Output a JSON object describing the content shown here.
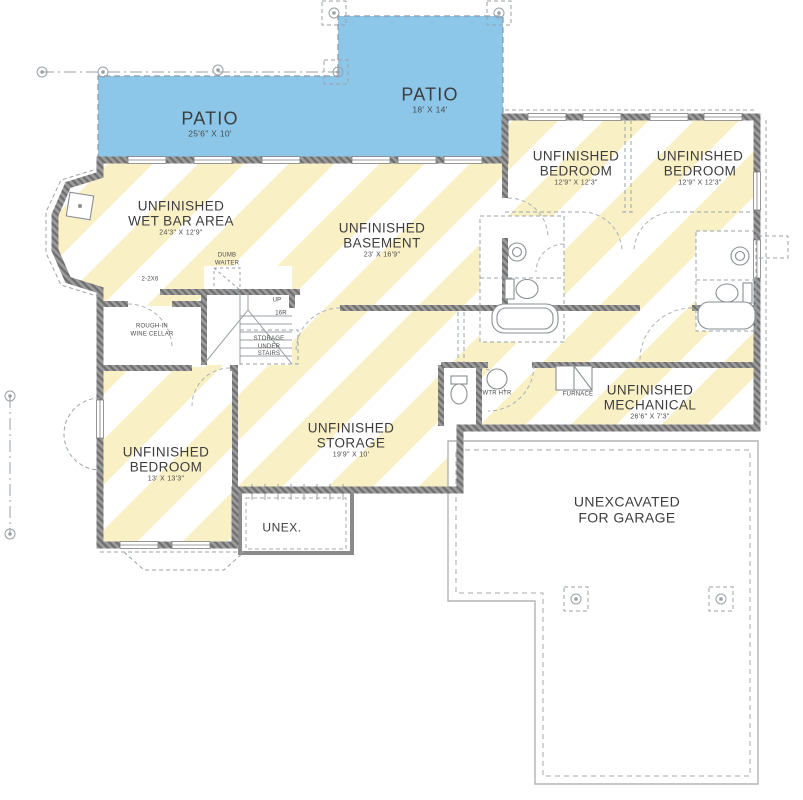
{
  "plan_type": "Basement Floor Plan",
  "colors": {
    "patio_fill": "#8CC7E9",
    "stripe_yellow": "#FAF0C6",
    "wall_base": "#9B9B9B",
    "wall_fleck": "#6E6E6E"
  },
  "rooms": {
    "patio_left": {
      "name": "PATIO",
      "dims": "25'6\" X 10'"
    },
    "patio_right": {
      "name": "PATIO",
      "dims": "18' X 14'"
    },
    "wet_bar": {
      "l1": "UNFINISHED",
      "l2": "WET BAR AREA",
      "dims": "24'3\" X 12'9\""
    },
    "basement": {
      "l1": "UNFINISHED",
      "l2": "BASEMENT",
      "dims": "23' X 16'9\""
    },
    "bedroom_top_left": {
      "l1": "UNFINISHED",
      "l2": "BEDROOM",
      "dims": "12'9\" X 12'3\""
    },
    "bedroom_top_right": {
      "l1": "UNFINISHED",
      "l2": "BEDROOM",
      "dims": "12'9\" X 12'3\""
    },
    "bedroom_lower": {
      "l1": "UNFINISHED",
      "l2": "BEDROOM",
      "dims": "13' X 13'3\""
    },
    "storage": {
      "l1": "UNFINISHED",
      "l2": "STORAGE",
      "dims": "19'9\" X 10'"
    },
    "mechanical": {
      "l1": "UNFINISHED",
      "l2": "MECHANICAL",
      "dims": "26'6\" X 7'3\""
    },
    "unexcavated": {
      "l1": "UNEXCAVATED",
      "l2": "FOR GARAGE"
    },
    "unex": {
      "name": "UNEX."
    }
  },
  "annotations": {
    "dumb_waiter_l1": "DUMB",
    "dumb_waiter_l2": "WAITER",
    "joist": "2-2X6",
    "wine_l1": "ROUGH-IN",
    "wine_l2": "WINE CELLAR",
    "up": "UP",
    "risers": "16R",
    "under_stairs_l1": "STORAGE",
    "under_stairs_l2": "UNDER",
    "under_stairs_l3": "STAIRS",
    "water_heater": "WTR HTR",
    "furnace": "FURNACE"
  }
}
